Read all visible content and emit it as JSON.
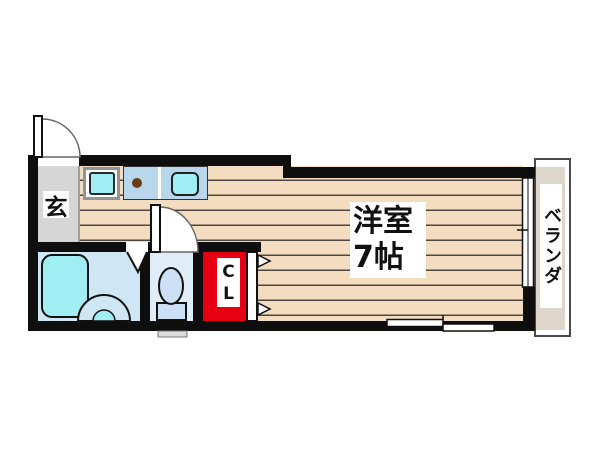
{
  "floorplan": {
    "rooms": {
      "entrance": {
        "label": "玄"
      },
      "main_room": {
        "name": "洋室",
        "size": "7帖"
      },
      "closet": {
        "letter_top": "C",
        "letter_bottom": "L"
      },
      "veranda": {
        "label": "ベランダ"
      }
    },
    "fixtures": [
      "entrance-door-swing",
      "washing-machine-pan",
      "stove-burner",
      "kitchen-sink",
      "interior-door-swing",
      "bathroom-folding-door",
      "bathtub",
      "washbasin",
      "toilet",
      "closet-folding-door",
      "sliding-window-right",
      "sliding-window-bottom"
    ],
    "colors": {
      "wall": "#0e0e0e",
      "wood_floor": "#f4dcc1",
      "wood_line": "#4e4740",
      "entrance_floor": "#d6d6d6",
      "counter_blue": "#b9d7ec",
      "cyan": "#a0eef4",
      "bathroom_blue": "#cfe6f4",
      "toilet_room_blue": "#e0ecf8",
      "fixture_blue": "#cbe0f4",
      "closet_red": "#e60012",
      "veranda_floor": "#ded6ca",
      "burner_brown": "#6b3c10"
    }
  }
}
